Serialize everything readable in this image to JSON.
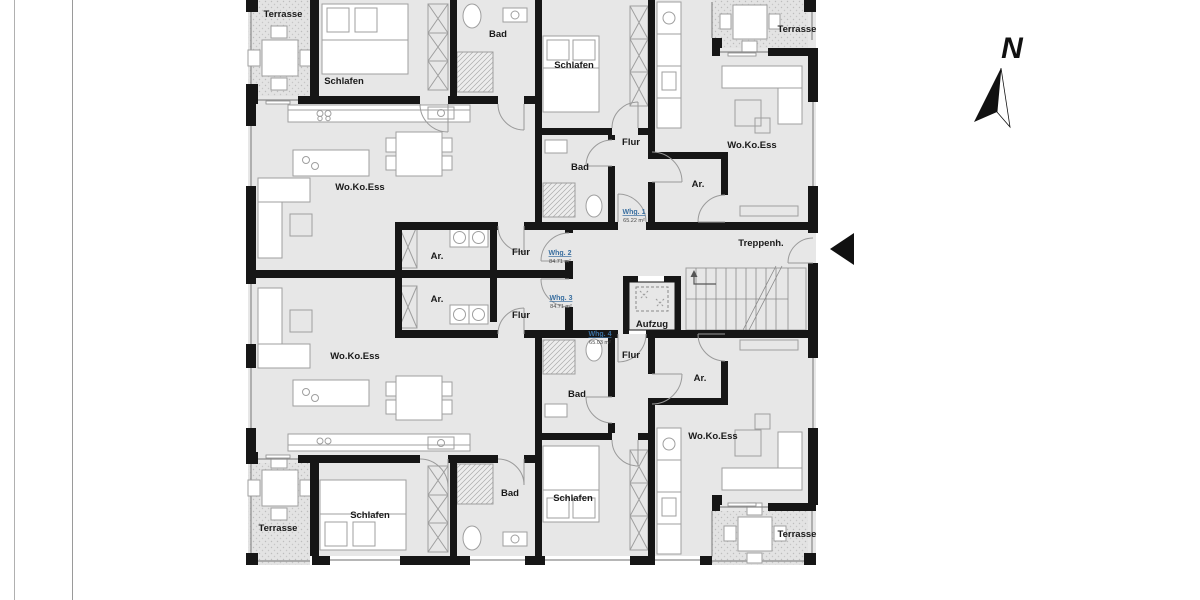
{
  "colors": {
    "apartment_label": "#3a6fa0",
    "wall": "#161616",
    "room_fill": "#e7e7e7"
  },
  "compass": {
    "label": "N"
  },
  "core": {
    "stairs": "Treppenh.",
    "elevator": "Aufzug"
  },
  "rooms": [
    {
      "label": "Terrasse"
    },
    {
      "label": "Schlafen"
    },
    {
      "label": "Bad"
    },
    {
      "label": "Schlafen"
    },
    {
      "label": "Flur"
    },
    {
      "label": "Bad"
    },
    {
      "label": "Wo.Ko.Ess"
    },
    {
      "label": "Ar."
    },
    {
      "label": "Terrasse"
    },
    {
      "label": "Wo.Ko.Ess"
    },
    {
      "label": "Flur"
    },
    {
      "label": "Ar."
    },
    {
      "label": "Ar."
    },
    {
      "label": "Flur"
    },
    {
      "label": "Wo.Ko.Ess"
    },
    {
      "label": "Flur"
    },
    {
      "label": "Ar."
    },
    {
      "label": "Bad"
    },
    {
      "label": "Wo.Ko.Ess"
    },
    {
      "label": "Schlafen"
    },
    {
      "label": "Bad"
    },
    {
      "label": "Schlafen"
    },
    {
      "label": "Terrasse"
    },
    {
      "label": "Terrasse"
    }
  ],
  "apartments": [
    {
      "name": "Whg. 1",
      "area": "65.22 m²"
    },
    {
      "name": "Whg. 2",
      "area": "84.71 m²"
    },
    {
      "name": "Whg. 3",
      "area": "84.71 m²"
    },
    {
      "name": "Whg. 4",
      "area": "65.03 m²"
    }
  ]
}
